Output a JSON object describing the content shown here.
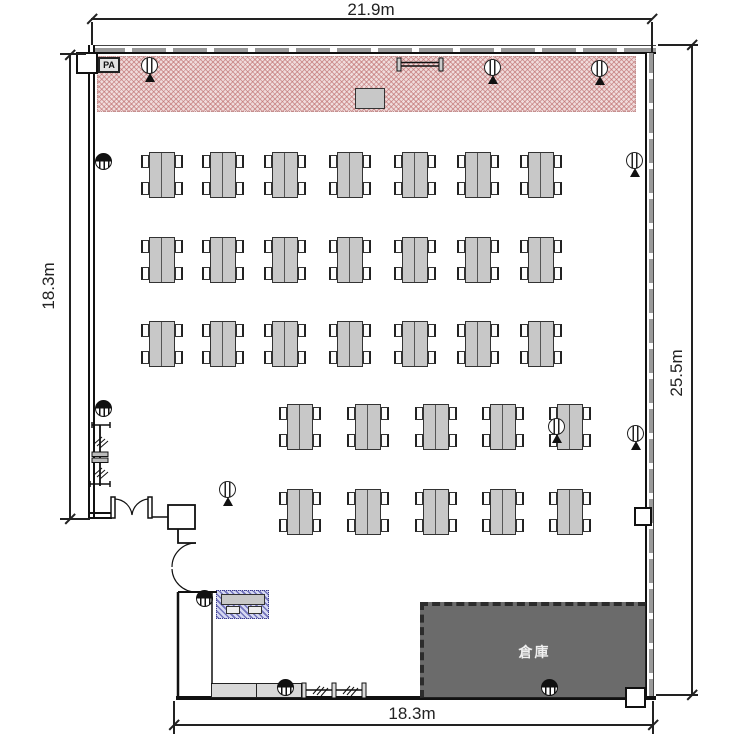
{
  "dimensions": {
    "top": "21.9m",
    "left": "18.3m",
    "right": "25.5m",
    "bottom": "18.3m"
  },
  "stage": {
    "pa_label": "PA"
  },
  "storage": {
    "label": "倉庫"
  },
  "tables": {
    "seats_per_table": 4,
    "top_grid": {
      "xs": [
        141,
        202,
        264,
        329,
        394,
        457,
        520
      ],
      "ys": [
        152,
        237,
        321
      ]
    },
    "bottom_grid": {
      "xs": [
        279,
        347,
        415,
        482,
        549
      ],
      "ys": [
        404,
        489
      ]
    }
  },
  "speakers": {
    "ceiling": [
      [
        141,
        57
      ],
      [
        484,
        59
      ],
      [
        591,
        60
      ],
      [
        626,
        152
      ],
      [
        627,
        425
      ],
      [
        219,
        481
      ],
      [
        548,
        418
      ]
    ],
    "wall": [
      [
        95,
        153
      ],
      [
        95,
        400
      ],
      [
        196,
        590
      ],
      [
        277,
        679
      ],
      [
        541,
        679
      ]
    ]
  },
  "colors": {
    "stage_fill": "#f0dcdc",
    "stage_hatch": "#b96464",
    "storage_fill": "#6b6b6b",
    "table_fill": "#c8c8c8",
    "counter_fill": "#d8d8d8",
    "reception_hatch": "#3c3ca0",
    "wall_dash": "#9a9a9a",
    "line": "#111111"
  }
}
